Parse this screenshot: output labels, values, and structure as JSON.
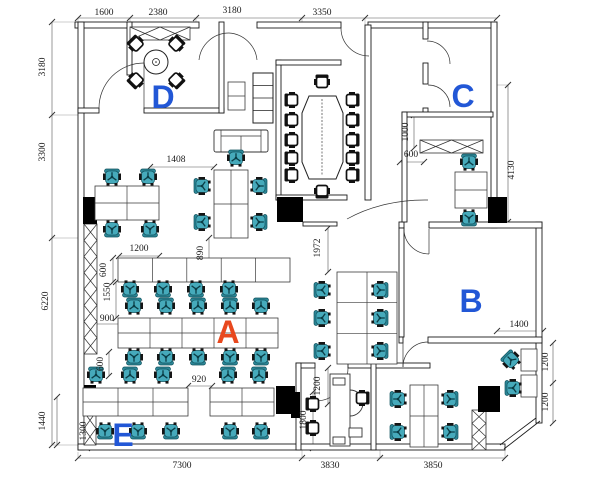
{
  "drawing_type": "office floor plan (CAD)",
  "colors": {
    "background": "#ffffff",
    "wall_line": "#1a1a1a",
    "dim_line": "#555555",
    "dim_text": "#1a1a1a",
    "room_label_blue": "#2257d6",
    "room_label_red": "#e8481e",
    "chair_teal": "#46aabb",
    "chair_teal_dark": "#10525e",
    "chair_black": "#111111"
  },
  "room_labels": [
    {
      "text": "D",
      "x": 163,
      "y": 108,
      "color": "#2257d6"
    },
    {
      "text": "C",
      "x": 463,
      "y": 107,
      "color": "#2257d6"
    },
    {
      "text": "B",
      "x": 471,
      "y": 312,
      "color": "#2257d6"
    },
    {
      "text": "A",
      "x": 228,
      "y": 343,
      "color": "#e8481e"
    },
    {
      "text": "E",
      "x": 123,
      "y": 446,
      "color": "#2257d6"
    }
  ],
  "dimensions": [
    {
      "text": "1600",
      "x": 104,
      "y": 15,
      "v": 0
    },
    {
      "text": "2380",
      "x": 158,
      "y": 15,
      "v": 0
    },
    {
      "text": "3180",
      "x": 232,
      "y": 13,
      "v": 0
    },
    {
      "text": "3350",
      "x": 322,
      "y": 15,
      "v": 0
    },
    {
      "text": "3180",
      "x": 45,
      "y": 67,
      "v": 1
    },
    {
      "text": "3300",
      "x": 45,
      "y": 152,
      "v": 1
    },
    {
      "text": "6220",
      "x": 48,
      "y": 301,
      "v": 1
    },
    {
      "text": "1440",
      "x": 45,
      "y": 421,
      "v": 1
    },
    {
      "text": "7300",
      "x": 182,
      "y": 468,
      "v": 0
    },
    {
      "text": "3830",
      "x": 330,
      "y": 468,
      "v": 0
    },
    {
      "text": "3850",
      "x": 433,
      "y": 468,
      "v": 0
    },
    {
      "text": "4130",
      "x": 514,
      "y": 170,
      "v": 1
    },
    {
      "text": "1408",
      "x": 176,
      "y": 162,
      "v": 0
    },
    {
      "text": "1200",
      "x": 139,
      "y": 251,
      "v": 0
    },
    {
      "text": "600",
      "x": 106,
      "y": 270,
      "v": 1
    },
    {
      "text": "890",
      "x": 203,
      "y": 253,
      "v": 1
    },
    {
      "text": "1550",
      "x": 110,
      "y": 292,
      "v": 1
    },
    {
      "text": "900",
      "x": 107,
      "y": 321,
      "v": 0
    },
    {
      "text": "600",
      "x": 103,
      "y": 364,
      "v": 1
    },
    {
      "text": "920",
      "x": 199,
      "y": 382,
      "v": 0
    },
    {
      "text": "1300",
      "x": 86,
      "y": 431,
      "v": 1
    },
    {
      "text": "1972",
      "x": 320,
      "y": 248,
      "v": 1
    },
    {
      "text": "1200",
      "x": 320,
      "y": 386,
      "v": 1
    },
    {
      "text": "1800",
      "x": 306,
      "y": 420,
      "v": 1
    },
    {
      "text": "1000",
      "x": 408,
      "y": 132,
      "v": 1
    },
    {
      "text": "600",
      "x": 411,
      "y": 157,
      "v": 0
    },
    {
      "text": "1400",
      "x": 519,
      "y": 327,
      "v": 0
    },
    {
      "text": "1200",
      "x": 548,
      "y": 362,
      "v": 1
    },
    {
      "text": "1200",
      "x": 548,
      "y": 402,
      "v": 1
    }
  ],
  "plan": {
    "walls": [
      [
        75,
        22,
        124,
        6
      ],
      [
        257,
        22,
        84,
        6
      ],
      [
        368,
        22,
        129,
        6
      ],
      [
        78,
        22,
        6,
        428
      ],
      [
        78,
        444,
        427,
        6
      ],
      [
        491,
        22,
        6,
        206
      ],
      [
        536,
        222,
        6,
        201
      ],
      [
        399,
        222,
        5,
        6
      ],
      [
        429,
        222,
        113,
        6
      ],
      [
        78,
        108,
        21,
        5
      ],
      [
        144,
        108,
        80,
        5
      ],
      [
        219,
        22,
        5,
        91
      ],
      [
        127,
        22,
        5,
        53
      ],
      [
        276,
        60,
        5,
        140
      ],
      [
        276,
        60,
        65,
        5
      ],
      [
        365,
        25,
        6,
        175
      ],
      [
        276,
        195,
        71,
        5
      ],
      [
        423,
        22,
        5,
        17
      ],
      [
        423,
        63,
        5,
        21
      ],
      [
        423,
        108,
        5,
        8
      ],
      [
        402,
        112,
        91,
        5
      ],
      [
        402,
        112,
        5,
        110
      ],
      [
        399,
        228,
        5,
        109
      ],
      [
        399,
        337,
        4,
        6
      ],
      [
        428,
        337,
        114,
        6
      ],
      [
        296,
        363,
        19,
        5
      ],
      [
        348,
        363,
        82,
        5
      ],
      [
        296,
        363,
        5,
        87
      ],
      [
        371,
        363,
        5,
        87
      ],
      [
        303,
        222,
        34,
        4
      ]
    ],
    "lines": [
      [
        504,
        449,
        540,
        421
      ],
      [
        500,
        445,
        536,
        418
      ]
    ],
    "columns": [
      [
        83,
        197,
        14,
        27
      ],
      [
        277,
        197,
        26,
        25
      ],
      [
        84,
        385,
        12,
        27
      ],
      [
        276,
        386,
        19,
        28
      ],
      [
        488,
        197,
        19,
        26
      ],
      [
        478,
        386,
        22,
        26
      ],
      [
        291,
        392,
        9,
        26
      ]
    ],
    "hatched": [
      {
        "x": 84,
        "y": 224,
        "w": 13,
        "h": 130,
        "n": 8
      },
      {
        "x": 130,
        "y": 27,
        "w": 60,
        "h": 13,
        "n": 2
      },
      {
        "x": 420,
        "y": 140,
        "w": 63,
        "h": 13,
        "n": 2
      },
      {
        "x": 472,
        "y": 410,
        "w": 14,
        "h": 40,
        "n": 3
      },
      {
        "x": 84,
        "y": 412,
        "w": 12,
        "h": 33,
        "n": 2
      }
    ],
    "doors": [
      "M99,108 A45,45 0 0 1 144,63",
      "M144,63 L144,108",
      "M199,60 A30,30 0 0 1 229,33",
      "M257,60 A30,30 0 0 0 229,33",
      "M341,28 A28,28 0 0 0 369,56",
      "M450,64 A23,23 0 0 0 427,41",
      "M450,107 A22,22 0 0 0 428,85",
      "M347,219 A120,80 0 0 1 428,200",
      "M404,229 A25,25 0 0 0 429,254",
      "M429,229 L429,254",
      "M403,367 A25,25 0 0 1 428,342",
      "M403,342 L403,367",
      "M348,368 A33,33 0 0 1 315,401",
      "M315,368 L315,401"
    ],
    "dim_lines": [
      [
        78,
        18,
        497,
        18
      ],
      [
        52,
        22,
        52,
        445
      ],
      [
        57,
        397,
        57,
        445
      ],
      [
        78,
        458,
        505,
        458
      ],
      [
        508,
        85,
        508,
        222
      ],
      [
        150,
        167,
        214,
        167
      ],
      [
        119,
        256,
        159,
        256
      ],
      [
        113,
        258,
        113,
        282
      ],
      [
        209,
        238,
        209,
        268
      ],
      [
        116,
        282,
        116,
        318
      ],
      [
        92,
        324,
        122,
        324
      ],
      [
        109,
        352,
        109,
        376
      ],
      [
        188,
        386,
        212,
        386
      ],
      [
        92,
        414,
        92,
        448
      ],
      [
        328,
        228,
        328,
        272
      ],
      [
        328,
        368,
        328,
        404
      ],
      [
        313,
        392,
        313,
        448
      ],
      [
        414,
        115,
        414,
        148
      ],
      [
        400,
        162,
        424,
        162
      ],
      [
        497,
        331,
        543,
        331
      ],
      [
        553,
        343,
        553,
        423
      ]
    ],
    "extra_ticks": [
      [
        130,
        18
      ],
      [
        196,
        18
      ],
      [
        302,
        18
      ],
      [
        365,
        18
      ],
      [
        52,
        115
      ],
      [
        52,
        238
      ],
      [
        302,
        458
      ],
      [
        380,
        458
      ],
      [
        553,
        383
      ]
    ],
    "ext_lines": [
      [
        78,
        18,
        78,
        25
      ],
      [
        130,
        18,
        130,
        25
      ],
      [
        196,
        18,
        196,
        28
      ],
      [
        302,
        18,
        302,
        28
      ],
      [
        365,
        18,
        365,
        25
      ],
      [
        52,
        22,
        75,
        22
      ],
      [
        52,
        115,
        78,
        115
      ],
      [
        52,
        238,
        78,
        238
      ],
      [
        52,
        445,
        78,
        445
      ],
      [
        78,
        452,
        78,
        458
      ],
      [
        302,
        450,
        302,
        458
      ],
      [
        380,
        450,
        380,
        458
      ],
      [
        505,
        450,
        505,
        458
      ],
      [
        508,
        85,
        497,
        85
      ],
      [
        508,
        222,
        500,
        222
      ]
    ],
    "desks": [
      {
        "x": 95,
        "y": 186,
        "w": 64,
        "h": 34,
        "c": 2,
        "r": 2
      },
      {
        "x": 214,
        "y": 170,
        "w": 34,
        "h": 68,
        "c": 2,
        "r": 2
      },
      {
        "x": 118,
        "y": 258,
        "w": 172,
        "h": 24,
        "c": 5,
        "r": 1
      },
      {
        "x": 118,
        "y": 318,
        "w": 160,
        "h": 30,
        "c": 5,
        "r": 2
      },
      {
        "x": 83,
        "y": 388,
        "w": 105,
        "h": 28,
        "c": 3,
        "r": 2
      },
      {
        "x": 210,
        "y": 388,
        "w": 64,
        "h": 28,
        "c": 2,
        "r": 2
      },
      {
        "x": 337,
        "y": 272,
        "w": 60,
        "h": 92,
        "c": 2,
        "r": 3
      },
      {
        "x": 410,
        "y": 385,
        "w": 28,
        "h": 62,
        "c": 2,
        "r": 2
      },
      {
        "x": 521,
        "y": 349,
        "w": 16,
        "h": 22,
        "c": 1,
        "r": 1
      },
      {
        "x": 521,
        "y": 375,
        "w": 16,
        "h": 22,
        "c": 1,
        "r": 1
      },
      {
        "x": 455,
        "y": 172,
        "w": 32,
        "h": 36,
        "c": 1,
        "r": 2
      },
      {
        "x": 228,
        "y": 82,
        "w": 17,
        "h": 28,
        "c": 1,
        "r": 2
      }
    ],
    "cabinet": {
      "x": 253,
      "y": 73,
      "w": 20,
      "h": 50,
      "shelves": 3
    },
    "sofa": {
      "x": 214,
      "y": 130,
      "w": 54,
      "h": 22
    },
    "round_table": {
      "cx": 156,
      "cy": 62,
      "r": 12
    },
    "conf_table": {
      "path": "M309,96 L336,96 L343,113 L343,162 L336,179 L309,179 L302,162 L302,113 Z",
      "center_line": [
        322,
        99,
        322,
        176
      ]
    },
    "reception": {
      "rects": [
        [
          330,
          374,
          20,
          72
        ],
        [
          333,
          378,
          12,
          7
        ],
        [
          333,
          437,
          12,
          7
        ],
        [
          349,
          428,
          13,
          9
        ]
      ],
      "arc": "M350,390 A13,13 0 0 1 350,416"
    },
    "chairs_teal": [
      [
        112,
        177,
        0
      ],
      [
        148,
        177,
        0
      ],
      [
        112,
        229,
        180
      ],
      [
        150,
        229,
        180
      ],
      [
        202,
        186,
        270
      ],
      [
        202,
        222,
        270
      ],
      [
        259,
        186,
        90
      ],
      [
        259,
        222,
        90
      ],
      [
        236,
        158,
        0
      ],
      [
        130,
        289,
        180
      ],
      [
        163,
        289,
        180
      ],
      [
        196,
        289,
        180
      ],
      [
        229,
        289,
        180
      ],
      [
        134,
        306,
        0
      ],
      [
        166,
        306,
        0
      ],
      [
        198,
        306,
        0
      ],
      [
        230,
        306,
        0
      ],
      [
        261,
        306,
        0
      ],
      [
        134,
        357,
        180
      ],
      [
        166,
        357,
        180
      ],
      [
        198,
        357,
        180
      ],
      [
        230,
        357,
        180
      ],
      [
        261,
        357,
        180
      ],
      [
        96,
        375,
        0
      ],
      [
        130,
        375,
        0
      ],
      [
        163,
        375,
        0
      ],
      [
        228,
        375,
        0
      ],
      [
        259,
        375,
        0
      ],
      [
        105,
        431,
        180
      ],
      [
        138,
        431,
        180
      ],
      [
        171,
        431,
        180
      ],
      [
        230,
        431,
        180
      ],
      [
        261,
        431,
        180
      ],
      [
        322,
        290,
        270
      ],
      [
        322,
        318,
        270
      ],
      [
        322,
        351,
        270
      ],
      [
        380,
        290,
        90
      ],
      [
        380,
        318,
        90
      ],
      [
        380,
        351,
        90
      ],
      [
        398,
        399,
        270
      ],
      [
        398,
        432,
        270
      ],
      [
        450,
        399,
        90
      ],
      [
        450,
        432,
        90
      ],
      [
        511,
        360,
        315
      ],
      [
        513,
        388,
        270
      ],
      [
        469,
        162,
        0
      ],
      [
        469,
        218,
        180
      ]
    ],
    "chairs_black": [
      [
        136,
        44,
        315
      ],
      [
        176,
        44,
        45
      ],
      [
        136,
        80,
        225
      ],
      [
        176,
        80,
        135
      ],
      [
        322,
        82,
        0
      ],
      [
        322,
        191,
        180
      ],
      [
        292,
        100,
        270
      ],
      [
        292,
        120,
        270
      ],
      [
        292,
        140,
        270
      ],
      [
        292,
        158,
        270
      ],
      [
        292,
        175,
        270
      ],
      [
        352,
        100,
        90
      ],
      [
        352,
        120,
        90
      ],
      [
        352,
        140,
        90
      ],
      [
        352,
        158,
        90
      ],
      [
        352,
        175,
        90
      ],
      [
        313,
        404,
        270
      ],
      [
        313,
        428,
        270
      ],
      [
        362,
        398,
        90
      ]
    ]
  }
}
